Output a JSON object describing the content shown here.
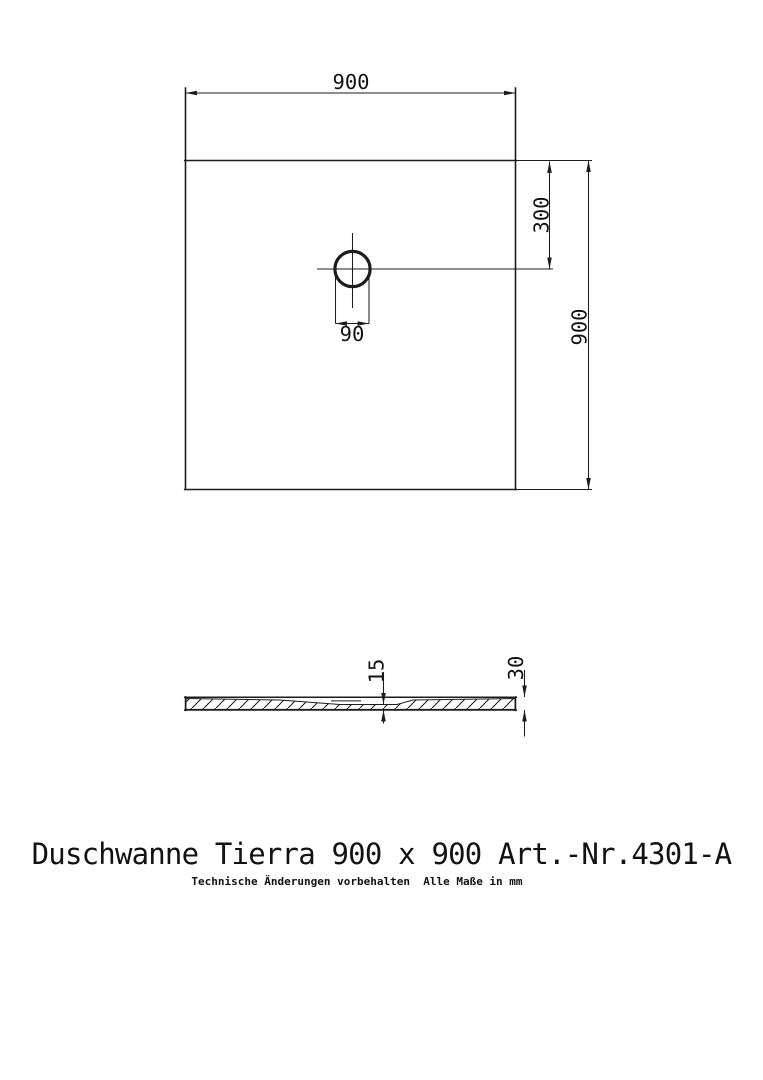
{
  "drawing": {
    "title": "Duschwanne Tierra 900 x 900 Art.-Nr.4301-A",
    "disclaimer": "Technische Änderungen vorbehalten  Alle Maße in mm",
    "colors": {
      "line": "#1c1c1c",
      "background": "#ffffff"
    },
    "top_view": {
      "width_label": "900",
      "height_label": "900",
      "drain_offset_label": "300",
      "drain_diameter_label": "90"
    },
    "section_view": {
      "center_thickness_label": "15",
      "edge_thickness_label": "30"
    }
  }
}
